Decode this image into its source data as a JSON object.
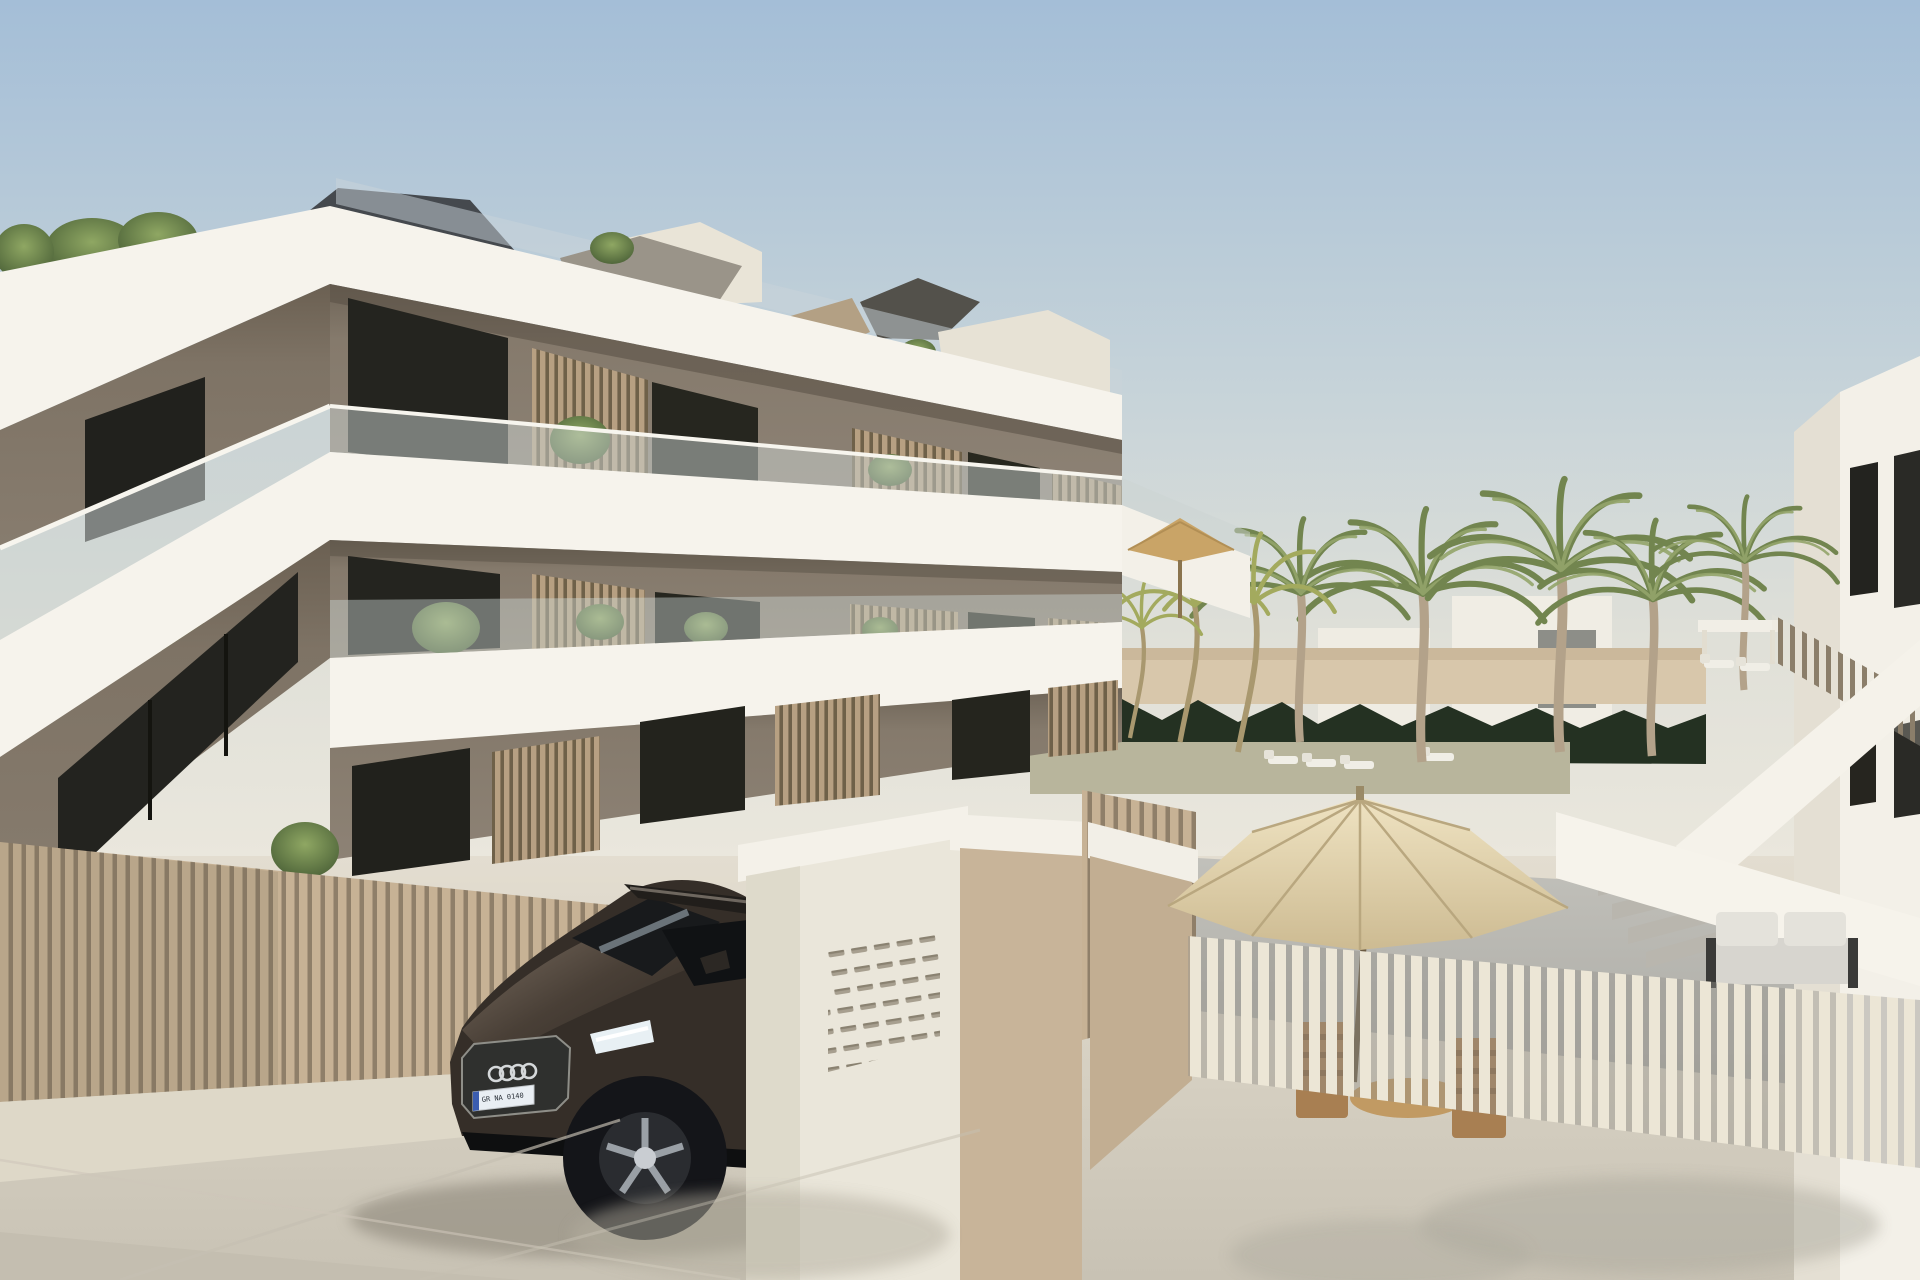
{
  "scene": {
    "type": "3D architectural exterior render",
    "setting": "Modern three-storey apartment residence with stacked white balcony slabs, taupe recessed walls, timber slat screens and glass balustrades; palm-lined pool courtyard to the right; entrance driveway with a parked dark SUV",
    "time_of_day": "daytime, clear sky",
    "visible_text_items": 1
  },
  "building": {
    "storeys": 3,
    "features": [
      "white wraparound slab fascias",
      "taupe recessed facade walls",
      "frameless glass balustrades",
      "timber vertical-slat privacy screens",
      "balcony planters with greenery",
      "roof terrace with tan shade sails",
      "dark grey hip roof element"
    ]
  },
  "car": {
    "type": "dark SUV (Audi-style four-ring grille badge)",
    "body_color_name": "dark umber black",
    "plate_text": "GR NA 0140",
    "plate_style": "EU plate with blue band"
  },
  "courtyard": {
    "large_palms": 5,
    "slim_golden_palms": 3,
    "hedge": "dark clipped hedge wall",
    "umbrellas": [
      {
        "style": "large cream parasol",
        "location": "front patio"
      },
      {
        "style": "small tan parasol",
        "location": "mid courtyard"
      },
      {
        "style": "angular tan shade sails",
        "location": "roof terraces"
      }
    ],
    "furniture": [
      "white sun loungers",
      "grey outdoor sofa",
      "timber dining chairs",
      "round timber table"
    ],
    "fences": [
      "tan vertical-slat street fence",
      "cream vertical-slat patio fence",
      "white solid stair parapets",
      "timber slat stair railing"
    ]
  },
  "mailboxes": {
    "panel": "recessed letterbox grid on white entrance wall",
    "rows": 6,
    "columns": 5
  },
  "colors": {
    "sky_top": "#a4bed7",
    "sky_mid": "#c6d3d9",
    "sky_horizon": "#eae7dd",
    "band_white": "#f6f3ec",
    "wall_taupe": "#857a6c",
    "wall_taupe_dark": "#6b6155",
    "slat_tan": "#c7b295",
    "screen_timber": "#b7a082",
    "fence_cream": "#ece6d6",
    "hedge_green": "#243122",
    "palm_green": "#7d9058",
    "palm_gold": "#b5b76b",
    "pavement_light": "#ddd7c9",
    "pavement_shadow": "#b5afa1",
    "patio_grey": "#b4b3ad",
    "car_body": "#3a332c",
    "roof_dark": "#45494e",
    "canopy_cream": "#e7d9b8",
    "canopy_tan": "#c9a467"
  }
}
